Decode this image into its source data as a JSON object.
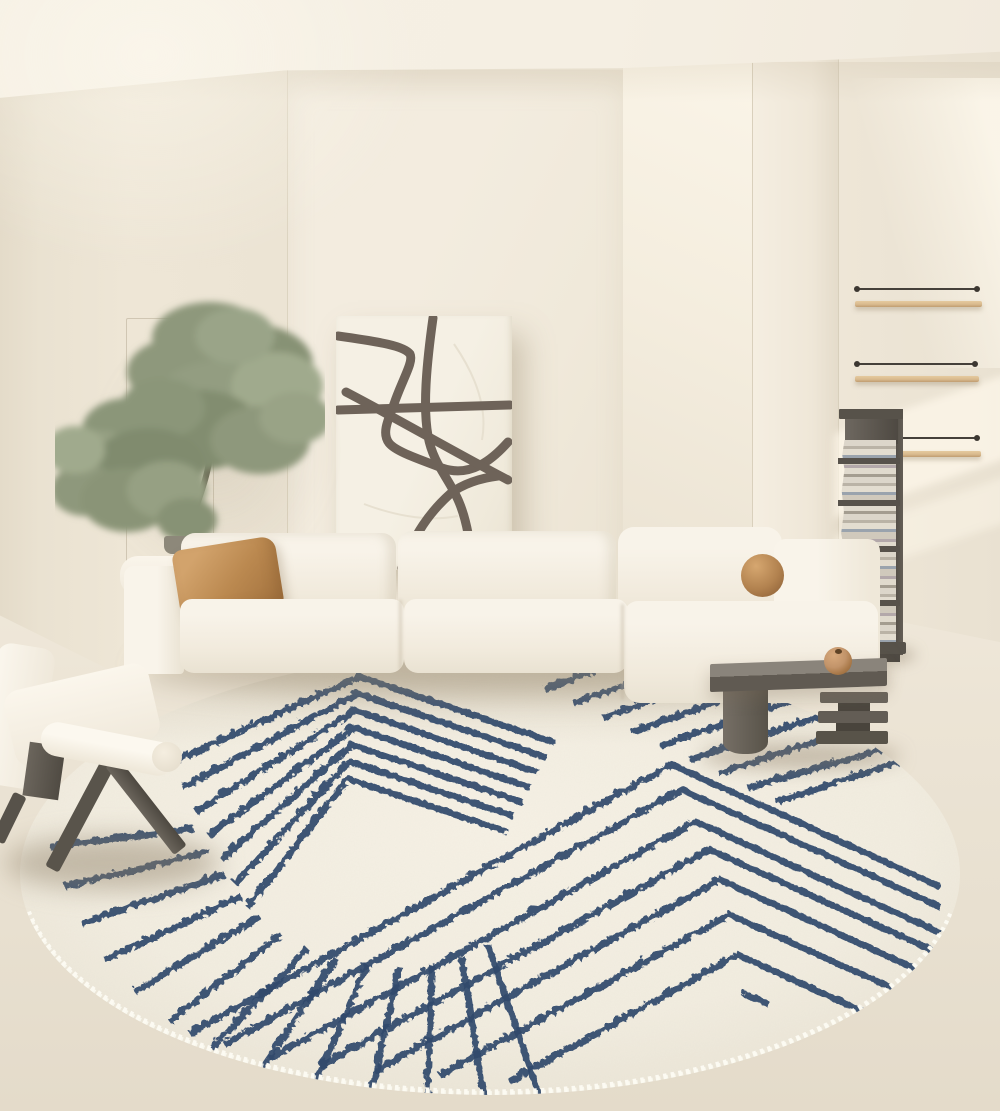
{
  "meta": {
    "type": "interior-photograph",
    "room": "living-room",
    "style": "minimalist cream scandinavian",
    "description": "Cream living room with modular sectional sofa, abstract line-art canvas, olive tree, wall shelves, vertical book-stack shelf, dark wood side table, white lounge chair and a large round cream rug with navy geometric stripe pattern and white zigzag stitched edge"
  },
  "palette": {
    "ceiling": "#f6f0e4",
    "wall": "#eee7d8",
    "wall_dark": "#e4dbc9",
    "floor": "#eae2d2",
    "rug_base": "#f2ede0",
    "rug_stripe": "#30496c",
    "rug_stitch": "#fcfaf2",
    "sofa": "#f8f3e9",
    "sofa_shade": "#e9e2d2",
    "pillow_caramel": "#bb8950",
    "art_canvas": "#f5f0e4",
    "art_line": "#6e6359",
    "foliage": "#8e987c",
    "trunk": "#6f6d58",
    "pot": "#8d887a",
    "wood_dark": "#57524a",
    "table_grey": "#6b655c",
    "shelf_wood": "#d9ba8e",
    "ball_tan": "#c2946a"
  },
  "objects": {
    "wall_art": {
      "name": "abstract curved-line canvas",
      "strokes": [
        "M 2,20 C 45,26 68,30 74,38 C 78,46 66,64 58,88 C 51,106 46,118 53,127 C 60,136 86,144 106,152 C 134,162 156,144 172,126",
        "M 97,2 C 90,52 87,92 92,120 C 97,148 113,162 123,186 C 131,205 135,230 136,252",
        "M 2,94 L 174,89",
        "M 10,76 C 60,102 122,138 172,164",
        "M 66,252 C 78,218 94,196 114,178 C 126,168 145,162 162,160"
      ],
      "faint_lines": [
        "M 118,28 C 140,60 152,92 146,124",
        "M 28,188 C 60,200 92,206 122,200"
      ]
    },
    "rug": {
      "name": "round cream rug with navy stripes",
      "edge": "white zigzag whipstitch",
      "pattern": {
        "chevrons_top_left": [
          "150,112 340,25 535,91",
          "163,136 338,42 527,106",
          "176,160 336,59 519,121",
          "189,184 334,76 511,136",
          "202,208 332,93 503,151",
          "215,232 330,110 495,165",
          "228,256 328,127 487,180"
        ],
        "fan_stripes": [
          "175,177 30,195",
          "190,200 45,235",
          "205,223 62,272",
          "222,245 85,308",
          "240,265 115,340",
          "262,283 150,370",
          "288,297 192,397",
          "317,307 240,420",
          "348,313 293,437",
          "380,315 350,448",
          "412,313 408,452",
          "442,305 465,450",
          "468,293 520,444"
        ],
        "band_stripes_top_right": [
          "525,38 647,-8",
          "554,52 694,1",
          "583,66 742,10",
          "612,80 790,19",
          "641,94 837,27",
          "670,108 885,36",
          "699,122 933,45",
          "728,136 1010,56",
          "757,150 1010,68"
        ],
        "chevrons_right": [
          "170,382 652,113 920,235",
          "205,393 662,138 920,255",
          "250,407 676,170 920,281",
          "300,415 690,198 920,302",
          "355,420 700,228 920,328",
          "420,424 710,263 920,358",
          "490,430 718,303 920,395"
        ],
        "accent_dash": [
          "724,342 748,352"
        ]
      }
    },
    "sofa": {
      "name": "cream modular sectional sofa",
      "sections": [
        "left-arm",
        "back-cushion-left",
        "back-cushion-right",
        "corner-back",
        "right-arm",
        "seat-left",
        "seat-right",
        "chaise"
      ],
      "accent_pillow": {
        "shape": "square",
        "color": "#bb8950"
      },
      "ball_pillow": {
        "shape": "sphere",
        "color": "#b2824f"
      }
    },
    "tree": {
      "name": "potted olive tree",
      "clusters": 2
    },
    "chair": {
      "name": "white lounge chair with dark A-frame wood legs"
    },
    "side_table": {
      "name": "dark grey wood low table with cylinder leg and stacked slabs",
      "decor": "terracotta ball vase"
    },
    "book_tower": {
      "name": "vertical book stack shelf",
      "content": "stacked books and magazines"
    },
    "wall_shelves": {
      "count": 3,
      "material": "light wood with thin wire rail and end pins"
    }
  }
}
